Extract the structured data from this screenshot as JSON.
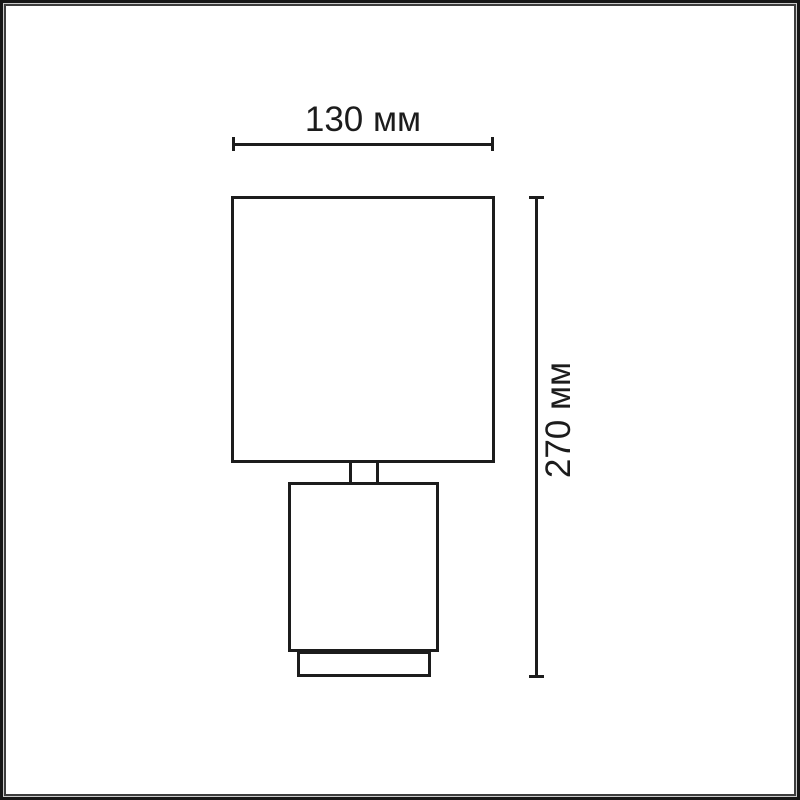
{
  "diagram": {
    "kind": "product dimensional drawing",
    "subject": "table lamp, front view outline",
    "stroke_color": "#1c1c1c",
    "background_color": "#ffffff",
    "width_dimension": {
      "label": "130 мм",
      "value": 130,
      "unit": "мм"
    },
    "height_dimension": {
      "label": "270 мм",
      "value": 270,
      "unit": "мм"
    },
    "parts": [
      {
        "name": "shade"
      },
      {
        "name": "neck"
      },
      {
        "name": "base"
      },
      {
        "name": "plinth"
      }
    ]
  },
  "frame": {
    "outer_border_color": "#161616",
    "gap_color": "#cbcbcb",
    "inner_border_color": "#3d3d3d"
  }
}
